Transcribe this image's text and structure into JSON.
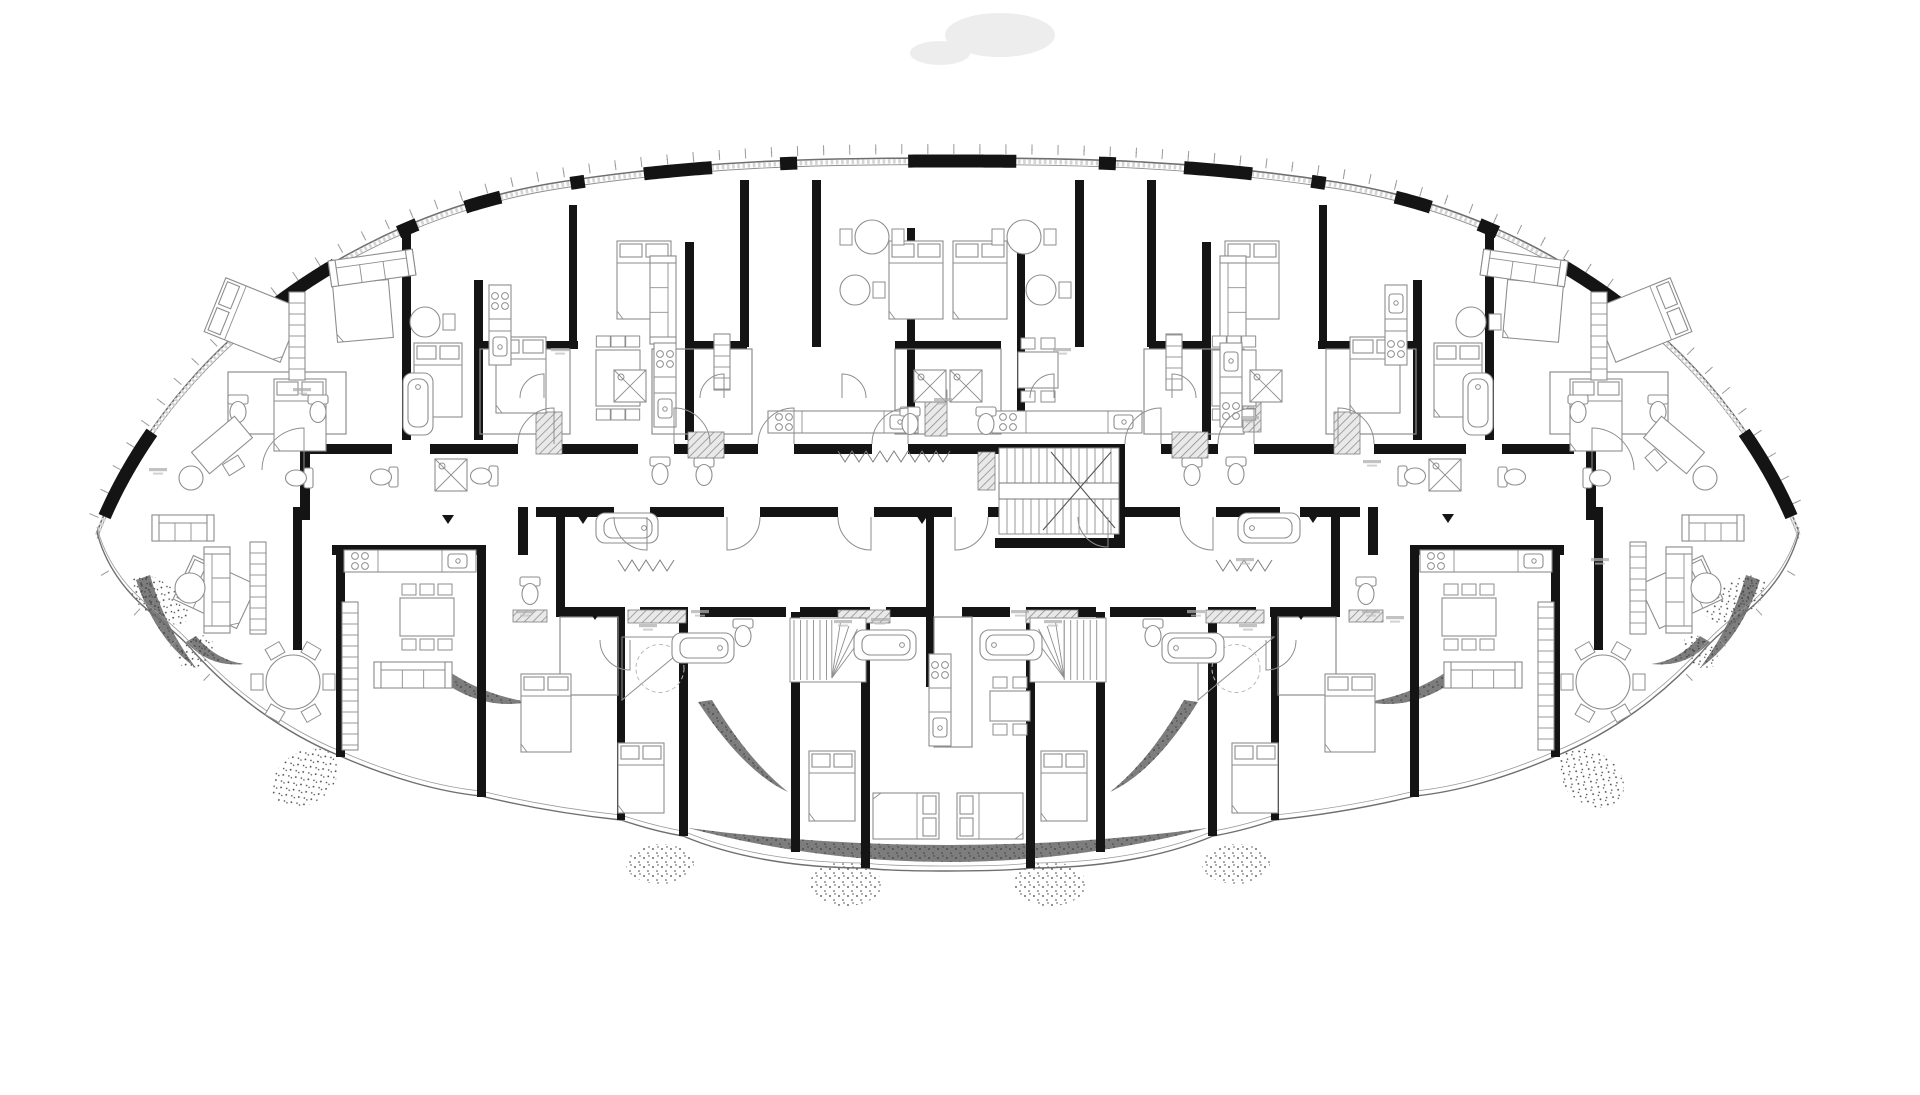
{
  "meta": {
    "drawing_type": "architectural floor plan",
    "subject": "elliptical lens-shaped residential tower floor plate with apartments around a central corridor",
    "style": "black and white CAD line drawing, thick black structural walls, thin grey furniture linework",
    "description": "Floor plan of a lens-shaped apartment tower: curved glazed facade with mullion ticks and black wall piers, central corridor with main stair, apartment units with beds, sofas, kitchens, bathrooms, and a scalloped terrace edge with planting at the bottom"
  },
  "colors": {
    "background": "#ffffff",
    "wall_black": "#141414",
    "line_grey": "#8e8e8e",
    "line_light": "#b9b9b9",
    "glass_band": "#d4d4d4",
    "planting_dark": "#6f6f6f",
    "stipple": "#3f3f3f",
    "hatch_fill": "#a8a8a8",
    "smudge": "#ededed"
  },
  "outline": {
    "top_path": "M97,532 C160,368 330,218 560,182 C700,160 820,158 948,158 C1076,158 1196,160 1336,182 C1566,218 1736,368 1799,532",
    "bottom_path": "M97,532 C104,560 122,592 158,618 C174,632 186,642 194,652 C232,694 282,732 340,756 C390,778 440,792 481,796 C522,806 564,814 621,820 C645,828 665,833 683,836 C735,858 800,868 865,868 C895,872 1001,872 1031,868 C1096,868 1161,858 1213,836 C1231,833 1251,828 1275,820 C1332,814 1374,806 1415,796 C1456,792 1506,778 1556,756 C1614,732 1664,694 1702,652 C1710,642 1722,632 1738,618 C1774,592 1792,560 1799,532",
    "tick_spacing": 26,
    "tick_len": 10,
    "pier_x_ranges": [
      [
        104,
        152
      ],
      [
        263,
        336
      ],
      [
        398,
        418
      ],
      [
        463,
        503
      ],
      [
        569,
        585
      ],
      [
        643,
        712
      ],
      [
        779,
        800
      ],
      [
        907,
        1017
      ],
      [
        1096,
        1117
      ],
      [
        1184,
        1253
      ],
      [
        1311,
        1327
      ],
      [
        1393,
        1433
      ],
      [
        1478,
        1498
      ],
      [
        1560,
        1633
      ],
      [
        1744,
        1792
      ]
    ]
  },
  "walls_black": [
    [
      402,
      224,
      9,
      216
    ],
    [
      474,
      280,
      9,
      160
    ],
    [
      569,
      205,
      8,
      136
    ],
    [
      685,
      242,
      9,
      198
    ],
    [
      740,
      180,
      9,
      167
    ],
    [
      812,
      180,
      9,
      167
    ],
    [
      907,
      228,
      8,
      192
    ],
    [
      1017,
      228,
      8,
      192
    ],
    [
      1075,
      180,
      9,
      167
    ],
    [
      1147,
      180,
      9,
      167
    ],
    [
      1202,
      242,
      9,
      198
    ],
    [
      1319,
      205,
      8,
      136
    ],
    [
      1413,
      280,
      9,
      160
    ],
    [
      1485,
      224,
      9,
      216
    ],
    [
      474,
      341,
      104,
      8
    ],
    [
      685,
      341,
      62,
      8
    ],
    [
      895,
      341,
      106,
      8
    ],
    [
      1149,
      341,
      62,
      8
    ],
    [
      1318,
      341,
      104,
      8
    ],
    [
      310,
      444,
      82,
      10
    ],
    [
      430,
      444,
      88,
      10
    ],
    [
      554,
      444,
      84,
      10
    ],
    [
      674,
      444,
      84,
      10
    ],
    [
      794,
      444,
      78,
      10
    ],
    [
      908,
      444,
      217,
      10
    ],
    [
      1161,
      444,
      57,
      10
    ],
    [
      1254,
      444,
      84,
      10
    ],
    [
      1374,
      444,
      92,
      10
    ],
    [
      1502,
      444,
      72,
      10
    ],
    [
      536,
      507,
      78,
      10
    ],
    [
      650,
      507,
      74,
      10
    ],
    [
      760,
      507,
      78,
      10
    ],
    [
      874,
      507,
      78,
      10
    ],
    [
      988,
      507,
      90,
      10
    ],
    [
      1104,
      507,
      76,
      10
    ],
    [
      1216,
      507,
      64,
      10
    ],
    [
      1300,
      507,
      60,
      10
    ],
    [
      332,
      545,
      152,
      10
    ],
    [
      1412,
      545,
      152,
      10
    ],
    [
      518,
      507,
      10,
      48
    ],
    [
      1368,
      507,
      10,
      48
    ],
    [
      300,
      444,
      10,
      76
    ],
    [
      1586,
      444,
      10,
      76
    ],
    [
      1114,
      444,
      11,
      104
    ],
    [
      995,
      538,
      130,
      10
    ],
    [
      293,
      507,
      9,
      143
    ],
    [
      336,
      545,
      9,
      212
    ],
    [
      477,
      545,
      9,
      252
    ],
    [
      556,
      517,
      9,
      90
    ],
    [
      617,
      607,
      8,
      213
    ],
    [
      679,
      607,
      9,
      229
    ],
    [
      791,
      612,
      9,
      240
    ],
    [
      861,
      607,
      9,
      261
    ],
    [
      926,
      517,
      8,
      170
    ],
    [
      1026,
      607,
      9,
      261
    ],
    [
      1096,
      612,
      9,
      240
    ],
    [
      1208,
      607,
      9,
      229
    ],
    [
      1271,
      607,
      8,
      213
    ],
    [
      1331,
      517,
      9,
      90
    ],
    [
      1410,
      545,
      9,
      252
    ],
    [
      1551,
      545,
      9,
      212
    ],
    [
      1594,
      507,
      9,
      143
    ],
    [
      556,
      607,
      64,
      10
    ],
    [
      640,
      607,
      48,
      10
    ],
    [
      700,
      607,
      86,
      10
    ],
    [
      800,
      607,
      70,
      10
    ],
    [
      886,
      607,
      48,
      10
    ],
    [
      962,
      607,
      48,
      10
    ],
    [
      1026,
      607,
      70,
      10
    ],
    [
      1110,
      607,
      86,
      10
    ],
    [
      1208,
      607,
      48,
      10
    ],
    [
      1270,
      607,
      70,
      10
    ]
  ],
  "partitions": [
    [
      480,
      349,
      90,
      85
    ],
    [
      652,
      349,
      100,
      85
    ],
    [
      895,
      349,
      106,
      85
    ],
    [
      228,
      372,
      118,
      62
    ],
    [
      560,
      617,
      58,
      78
    ],
    [
      934,
      617,
      38,
      130
    ],
    [
      1326,
      349,
      90,
      85
    ],
    [
      1144,
      349,
      100,
      85
    ],
    [
      1550,
      372,
      118,
      62
    ],
    [
      1278,
      617,
      58,
      78
    ]
  ],
  "shafts": [
    [
      536,
      412,
      26,
      42
    ],
    [
      688,
      432,
      36,
      26
    ],
    [
      925,
      390,
      22,
      46
    ],
    [
      978,
      452,
      17,
      38
    ],
    [
      628,
      610,
      58,
      13
    ],
    [
      838,
      610,
      52,
      13
    ],
    [
      513,
      610,
      34,
      12
    ],
    [
      1243,
      392,
      18,
      40
    ],
    [
      1026,
      610,
      52,
      13
    ],
    [
      1206,
      610,
      58,
      13
    ],
    [
      1349,
      610,
      34,
      12
    ],
    [
      1334,
      412,
      26,
      42
    ],
    [
      1172,
      432,
      36,
      26
    ]
  ],
  "stairs": {
    "main": {
      "x": 999,
      "y": 448,
      "w": 120,
      "h": 86,
      "step": 8,
      "landing_y": 483,
      "landing_h": 16
    },
    "duplex": [
      {
        "x": 790,
        "y": 618,
        "w": 76,
        "h": 64,
        "fan": "right"
      },
      {
        "x": 1030,
        "y": 618,
        "w": 76,
        "h": 64,
        "fan": "left"
      }
    ],
    "triangles": [
      {
        "x": 622,
        "y": 637,
        "w": 76,
        "h": 63
      },
      {
        "x": 1198,
        "y": 637,
        "w": 76,
        "h": 63
      }
    ]
  },
  "terrace": {
    "dark_crescents": [
      "M688,828 Q948,896 1208,828 Q948,862 688,828 Z",
      "M430,672 Q478,712 528,702 Q480,694 444,668 Z",
      "M1466,672 Q1418,712 1368,702 Q1416,694 1452,668 Z",
      "M698,702 Q744,772 788,792 Q748,760 712,700 Z",
      "M1198,702 Q1154,772 1110,792 Q1150,760 1184,700 Z",
      "M186,642 Q210,668 244,664 Q216,660 196,636 Z",
      "M1710,642 Q1686,668 1652,664 Q1680,660 1700,636 Z",
      "M136,580 Q156,640 196,668 Q164,625 150,575 Z",
      "M1760,580 Q1740,640 1700,668 Q1732,625 1746,575 Z"
    ],
    "stipple_ellipses": [
      [
        305,
        778,
        36,
        26,
        -35
      ],
      [
        1591,
        778,
        36,
        26,
        35
      ],
      [
        660,
        864,
        34,
        20,
        0
      ],
      [
        1236,
        864,
        34,
        20,
        0
      ],
      [
        1050,
        884,
        36,
        22,
        0
      ],
      [
        846,
        884,
        36,
        22,
        0
      ],
      [
        196,
        652,
        20,
        14,
        -40
      ],
      [
        1700,
        652,
        20,
        14,
        40
      ],
      [
        160,
        600,
        18,
        34,
        -55
      ],
      [
        1736,
        600,
        18,
        34,
        55
      ]
    ],
    "dashed_paths": [
      "M640,840 C780,915 1120,915 1260,840",
      "M690,800 C800,870 1100,870 1205,800",
      "M104,512 L276,514",
      "M1620,514 L1792,512",
      "M383,455 A42 42 0 0 0 341,497",
      "M1513,455 A42 42 0 0 1 1555,497",
      "M1060,657 Q1180,650 1300,646"
    ]
  },
  "furniture": {
    "beds": [
      [
        253,
        320,
        -68,
        58,
        82
      ],
      [
        362,
        300,
        -5,
        56,
        80
      ],
      [
        438,
        380,
        0,
        48,
        74
      ],
      [
        521,
        375,
        0,
        50,
        76
      ],
      [
        644,
        280,
        0,
        54,
        78
      ],
      [
        916,
        280,
        0,
        54,
        78
      ],
      [
        300,
        415,
        0,
        52,
        72
      ],
      [
        1643,
        320,
        68,
        58,
        82
      ],
      [
        1534,
        300,
        5,
        56,
        80
      ],
      [
        1458,
        380,
        0,
        48,
        74
      ],
      [
        1375,
        375,
        0,
        50,
        76
      ],
      [
        1252,
        280,
        0,
        54,
        78
      ],
      [
        980,
        280,
        0,
        54,
        78
      ],
      [
        1596,
        415,
        0,
        52,
        72
      ],
      [
        546,
        713,
        0,
        50,
        78
      ],
      [
        641,
        778,
        0,
        46,
        70
      ],
      [
        832,
        786,
        0,
        46,
        70
      ],
      [
        906,
        816,
        90,
        46,
        66
      ],
      [
        215,
        592,
        -65,
        48,
        70
      ],
      [
        1350,
        713,
        0,
        50,
        78
      ],
      [
        1255,
        778,
        0,
        46,
        70
      ],
      [
        1064,
        786,
        0,
        46,
        70
      ],
      [
        990,
        816,
        -90,
        46,
        66
      ],
      [
        1681,
        592,
        65,
        48,
        70
      ]
    ],
    "sofas": [
      [
        183,
        528,
        0,
        62
      ],
      [
        372,
        268,
        -8,
        85
      ],
      [
        663,
        300,
        90,
        88
      ],
      [
        413,
        675,
        0,
        78
      ],
      [
        1713,
        528,
        0,
        62
      ],
      [
        1524,
        268,
        8,
        85
      ],
      [
        1233,
        300,
        -90,
        88
      ],
      [
        1483,
        675,
        0,
        78
      ],
      [
        217,
        590,
        -90,
        86
      ],
      [
        1679,
        590,
        90,
        86
      ]
    ],
    "tables_round": [
      [
        293,
        682,
        27,
        6
      ],
      [
        1603,
        682,
        27,
        6
      ],
      [
        425,
        322,
        15,
        1
      ],
      [
        1471,
        322,
        15,
        1
      ],
      [
        855,
        290,
        15,
        1
      ],
      [
        1041,
        290,
        15,
        1
      ],
      [
        872,
        237,
        17,
        2
      ],
      [
        1024,
        237,
        17,
        2
      ]
    ],
    "poufs": [
      [
        190,
        588,
        15
      ],
      [
        1706,
        588,
        15
      ],
      [
        191,
        478,
        12
      ],
      [
        1705,
        478,
        12
      ]
    ],
    "tables_rect": [
      [
        618,
        378,
        0,
        44,
        56,
        3
      ],
      [
        1234,
        378,
        0,
        44,
        56,
        3
      ],
      [
        427,
        617,
        0,
        54,
        38,
        3
      ],
      [
        1469,
        617,
        0,
        54,
        38,
        3
      ],
      [
        1038,
        370,
        0,
        40,
        36,
        2
      ],
      [
        1010,
        706,
        0,
        40,
        30,
        2
      ]
    ],
    "kitchens": [
      [
        410,
        561,
        0,
        132
      ],
      [
        1486,
        561,
        0,
        132
      ],
      [
        843,
        422,
        0,
        150
      ],
      [
        1067,
        422,
        0,
        150
      ],
      [
        665,
        385,
        90,
        84
      ],
      [
        1231,
        385,
        -90,
        84
      ],
      [
        500,
        325,
        90,
        80
      ],
      [
        1396,
        325,
        -90,
        80
      ],
      [
        940,
        700,
        90,
        92
      ]
    ],
    "wardrobes": [
      [
        350,
        676,
        90,
        148
      ],
      [
        1546,
        676,
        -90,
        148
      ],
      [
        722,
        362,
        90,
        56
      ],
      [
        1174,
        362,
        -90,
        56
      ],
      [
        258,
        588,
        90,
        92
      ],
      [
        1638,
        588,
        -90,
        92
      ],
      [
        297,
        336,
        90,
        88
      ],
      [
        1599,
        336,
        -90,
        88
      ]
    ],
    "tubs": [
      [
        627,
        528,
        90
      ],
      [
        703,
        648,
        90
      ],
      [
        885,
        645,
        90
      ],
      [
        418,
        404,
        0
      ],
      [
        1269,
        528,
        -90
      ],
      [
        1193,
        648,
        -90
      ],
      [
        1011,
        645,
        -90
      ],
      [
        1478,
        404,
        0
      ]
    ],
    "toilets": [
      [
        238,
        408,
        0
      ],
      [
        318,
        408,
        0
      ],
      [
        485,
        476,
        90
      ],
      [
        660,
        470,
        0
      ],
      [
        704,
        471,
        0
      ],
      [
        910,
        420,
        0
      ],
      [
        743,
        632,
        0
      ],
      [
        300,
        478,
        90
      ],
      [
        385,
        477,
        90
      ],
      [
        530,
        590,
        0
      ],
      [
        1658,
        408,
        0
      ],
      [
        1578,
        408,
        0
      ],
      [
        1411,
        476,
        -90
      ],
      [
        1236,
        470,
        0
      ],
      [
        1192,
        471,
        0
      ],
      [
        986,
        420,
        0
      ],
      [
        1153,
        632,
        0
      ],
      [
        1596,
        478,
        -90
      ],
      [
        1511,
        477,
        -90
      ],
      [
        1366,
        590,
        0
      ]
    ],
    "showers": [
      [
        930,
        386
      ],
      [
        451,
        475
      ],
      [
        630,
        386
      ],
      [
        966,
        386
      ],
      [
        1445,
        475
      ],
      [
        1266,
        386
      ]
    ],
    "desks": [
      [
        222,
        445,
        -40
      ],
      [
        1674,
        445,
        40
      ]
    ]
  },
  "doors": [
    "M518,444 A36 36 0 0 1 554,408 L554,444",
    "M710,444 A36 36 0 0 0 674,408 L674,444",
    "M758,444 A36 36 0 0 1 794,408 L794,444",
    "M872,444 A36 36 0 0 1 908,408 L908,444",
    "M1125,444 A36 36 0 0 1 1161,408 L1161,444",
    "M1218,444 A36 36 0 0 1 1254,408 L1254,444",
    "M1374,444 A36 36 0 0 0 1338,408 L1338,444",
    "M614,517 A33 33 0 0 0 647,550 L647,517",
    "M760,517 A33 33 0 0 1 727,550 L727,517",
    "M838,517 A33 33 0 0 0 871,550 L871,517",
    "M988,517 A33 33 0 0 1 955,550 L955,517",
    "M1078,517 A30 30 0 0 0 1108,547 L1108,517",
    "M1180,517 A33 33 0 0 0 1213,550 L1213,517",
    "M520,398 A24 24 0 0 1 544,374 L544,398",
    "M700,398 A24 24 0 0 1 724,374 L724,398",
    "M866,398 A24 24 0 0 0 842,374 L842,398",
    "M1030,398 A24 24 0 0 1 1054,374 L1054,398",
    "M1196,398 A24 24 0 0 0 1172,374 L1172,398",
    "M262,470 A42 42 0 0 1 304,428 L304,470",
    "M1634,470 A42 42 0 0 0 1592,428 L1592,470",
    "M600,640 A30 30 0 0 0 630,670 L630,640",
    "M1296,640 A30 30 0 0 1 1266,670 L1266,640"
  ],
  "zigzags": [
    [
      618,
      560,
      62
    ],
    [
      1216,
      560,
      62
    ],
    [
      838,
      451,
      112
    ]
  ],
  "arrows": [
    [
      448,
      515
    ],
    [
      583,
      515
    ],
    [
      922,
      515
    ],
    [
      1313,
      514
    ],
    [
      1448,
      514
    ],
    [
      595,
      611
    ],
    [
      1301,
      611
    ]
  ],
  "micro_labels": [
    [
      648,
      626
    ],
    [
      843,
      622
    ],
    [
      700,
      612
    ],
    [
      525,
      612
    ],
    [
      880,
      620
    ],
    [
      1020,
      612
    ],
    [
      1245,
      560
    ],
    [
      943,
      400
    ],
    [
      1250,
      418
    ],
    [
      302,
      390
    ],
    [
      560,
      350
    ],
    [
      1062,
      350
    ],
    [
      1372,
      462
    ],
    [
      1395,
      618
    ],
    [
      1248,
      626
    ],
    [
      1053,
      622
    ],
    [
      1196,
      612
    ],
    [
      1371,
      612
    ],
    [
      158,
      470
    ],
    [
      1600,
      560
    ]
  ],
  "smudge": {
    "cx": 1000,
    "cy": 35,
    "rx": 55,
    "ry": 22
  }
}
